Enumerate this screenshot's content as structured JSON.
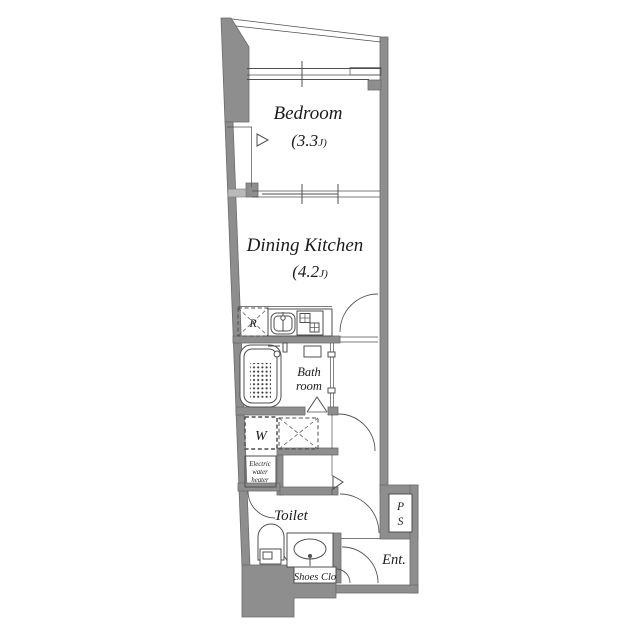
{
  "colors": {
    "wall": "#8e8e8e",
    "line": "#4f4f4f",
    "text": "#1b1b1b",
    "bg": "#ffffff"
  },
  "rooms": {
    "bedroom": {
      "label": "Bedroom",
      "area_num": "(3.3",
      "area_unit": "J)"
    },
    "dining_kitchen": {
      "label": "Dining Kitchen",
      "area_num": "(4.2",
      "area_unit": "J)"
    },
    "bath": {
      "lines": [
        "Bath",
        "room"
      ]
    },
    "toilet": {
      "label": "Toilet"
    },
    "entrance": {
      "label": "Ent."
    },
    "shoes_closet": {
      "label": "Shoes Clo"
    },
    "pipe_space": {
      "lines": [
        "P",
        "S"
      ]
    },
    "water_heater": {
      "lines": [
        "Electric",
        "water",
        "heater"
      ]
    },
    "washer": {
      "label": "W"
    },
    "refrigerator": {
      "label": "R"
    }
  }
}
